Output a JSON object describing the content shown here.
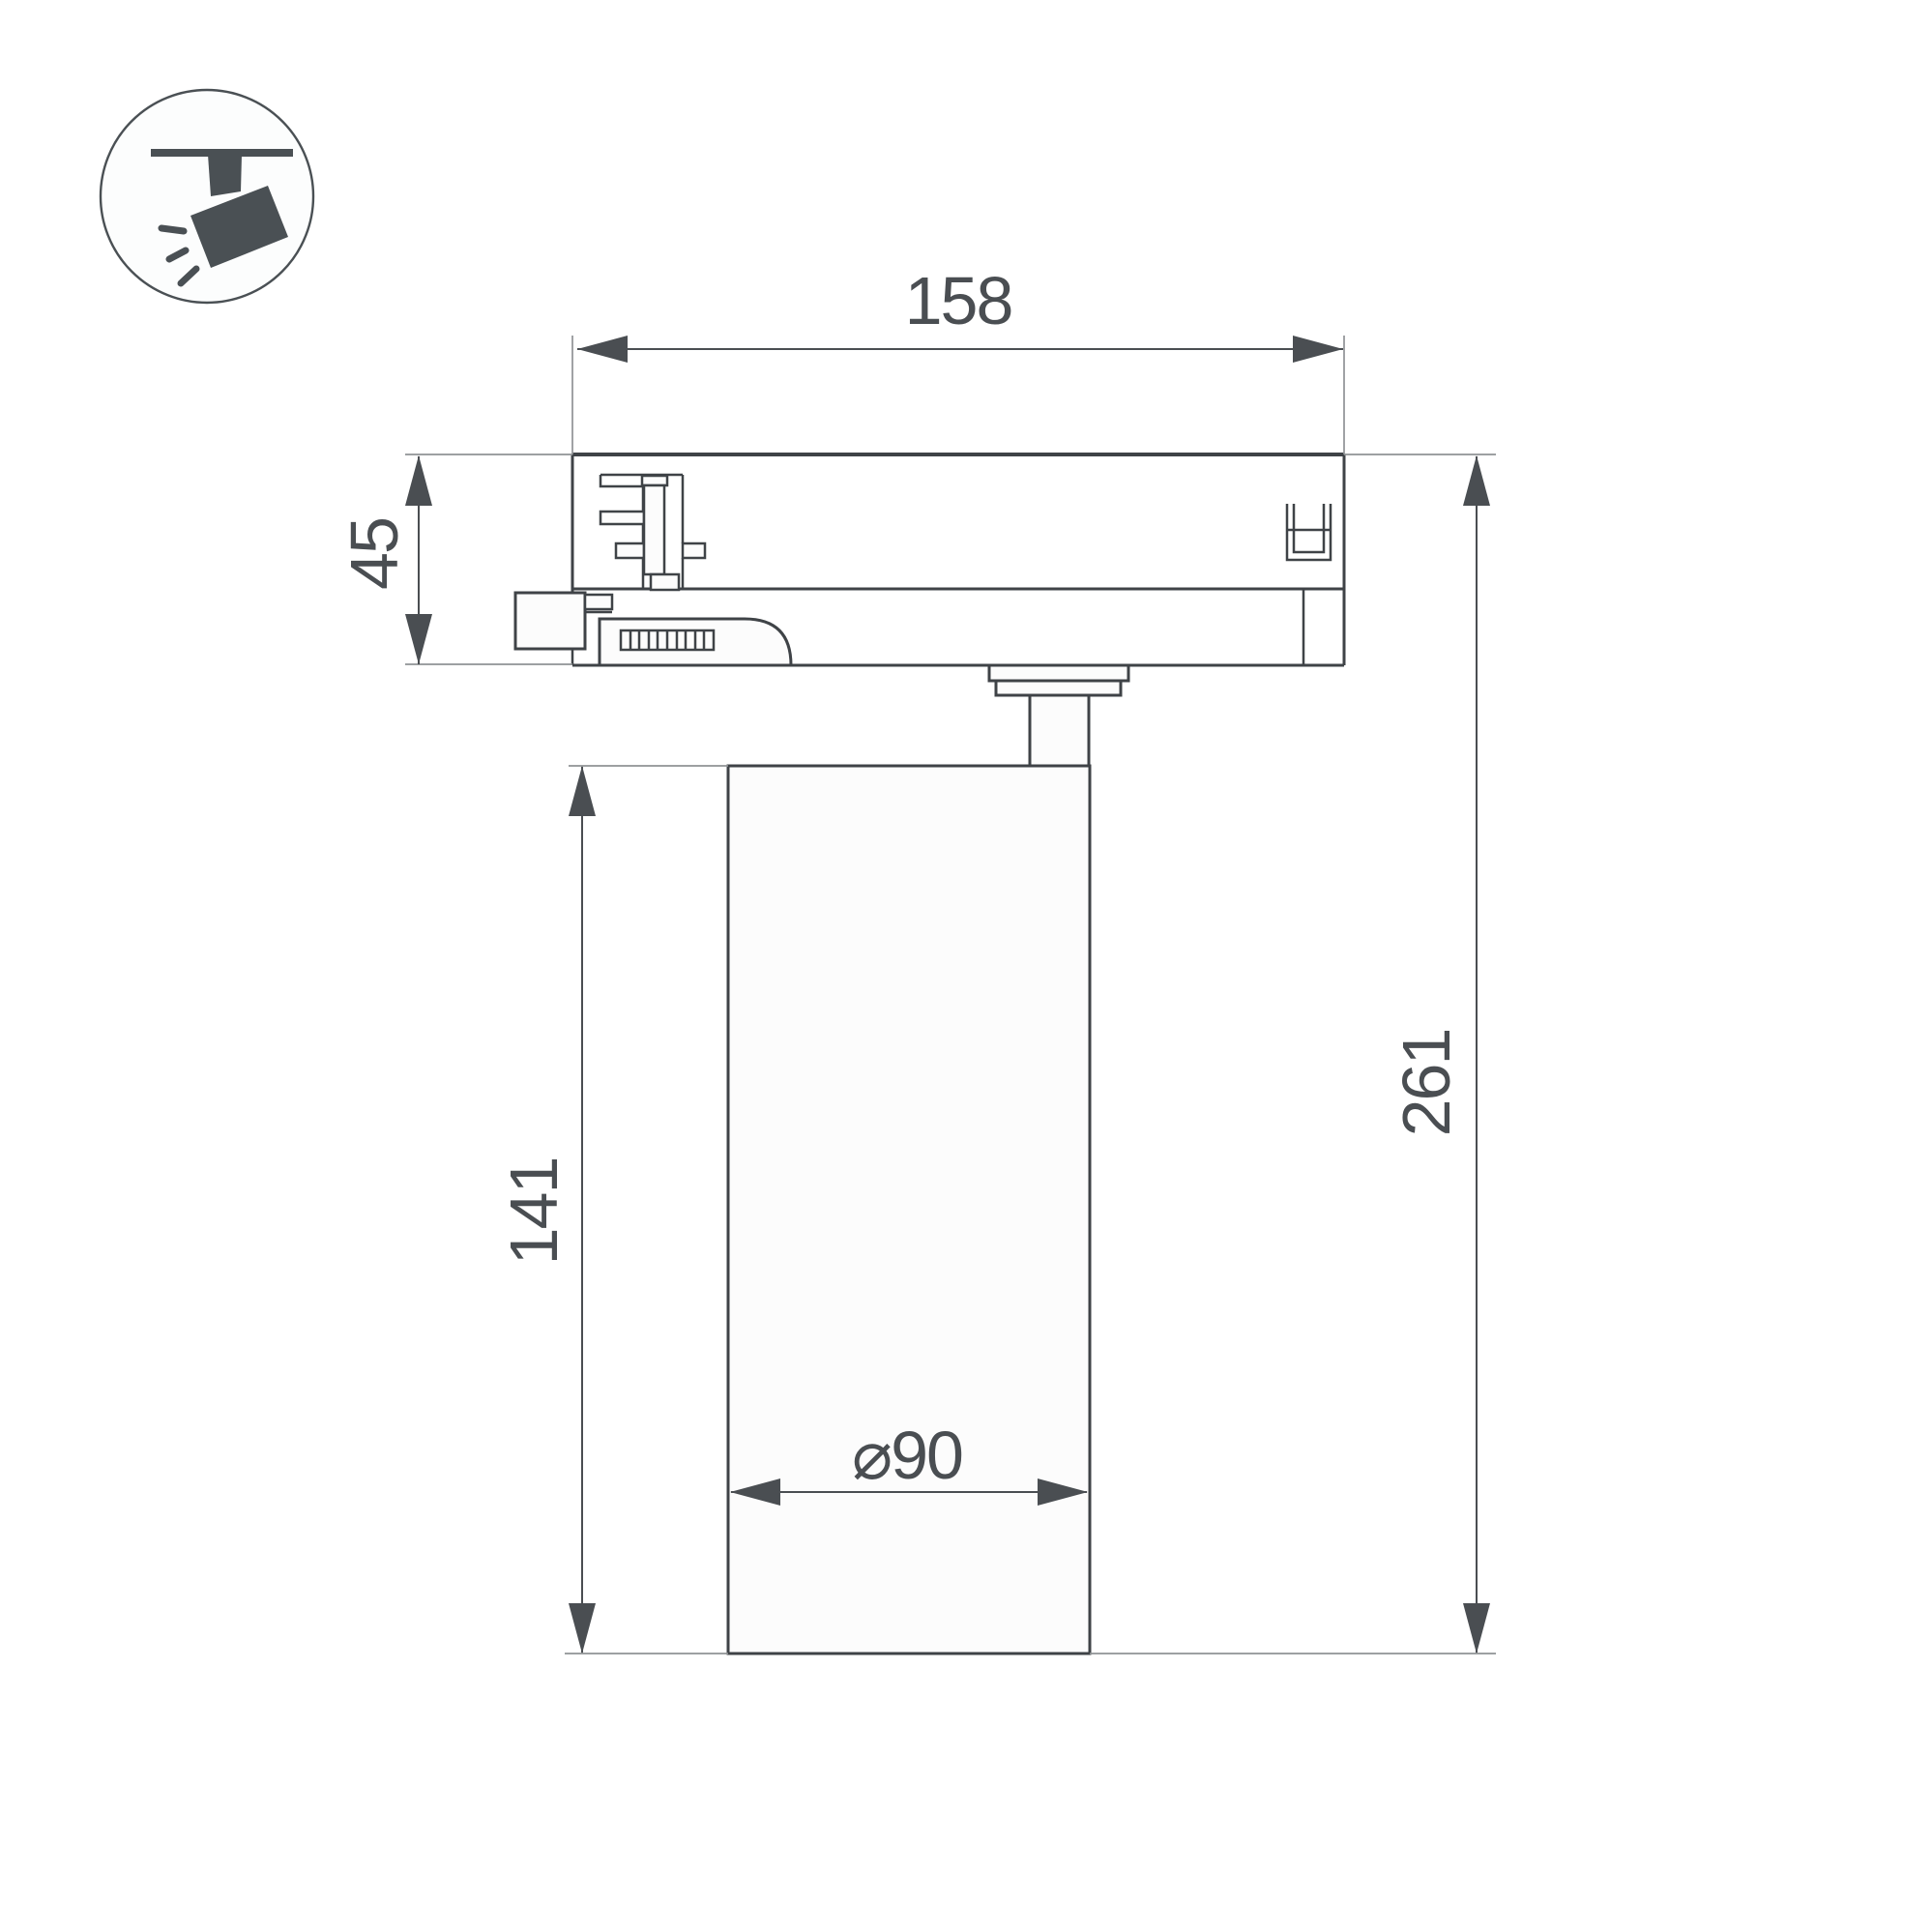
{
  "page": {
    "kind": "technical dimension drawing",
    "subject": "LED track spotlight side view"
  },
  "icon": {
    "name": "track-spotlight-icon"
  },
  "drawing": {
    "labels": {
      "width_top": "158",
      "adapter_height": "45",
      "body_height": "141",
      "total_height": "261",
      "diameter": "⌀90"
    },
    "colors": {
      "outline": "#3f4347",
      "dim": "#4a4e52",
      "ext": "#8f9295",
      "shape_fill": "#fcfcfc",
      "icon": "#4a5054",
      "background": "#ffffff"
    }
  }
}
